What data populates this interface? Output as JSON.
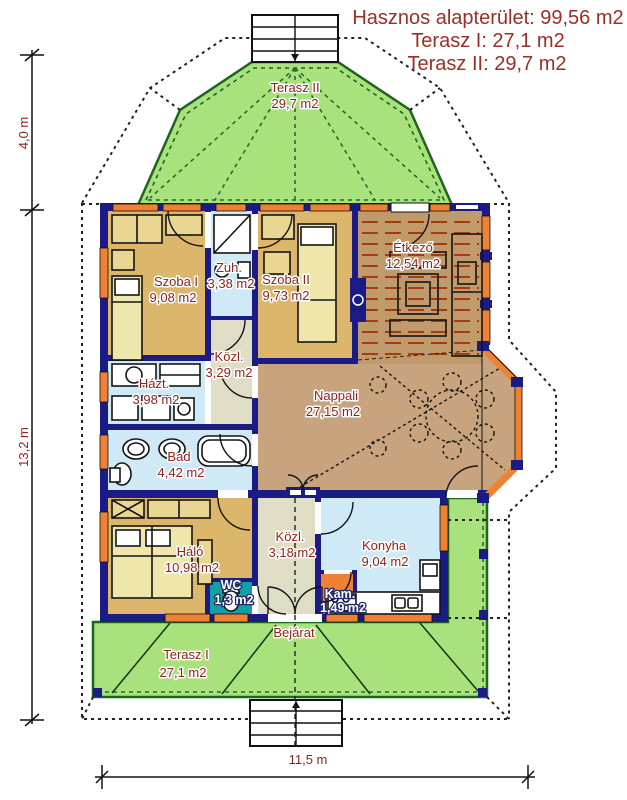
{
  "header": {
    "line1": "Hasznos alapterület: 99,56 m2",
    "line2": "Terasz I: 27,1 m2",
    "line3": "Terasz II: 29,7 m2"
  },
  "rooms": {
    "terasz2": {
      "name": "Terasz II",
      "area": "29,7 m2"
    },
    "szoba1": {
      "name": "Szoba I",
      "area": "9,08 m2"
    },
    "zuh": {
      "name": "Zuh.",
      "area": "3,38 m2"
    },
    "szoba2": {
      "name": "Szoba II",
      "area": "9,73 m2"
    },
    "etkezo": {
      "name": "Étkező",
      "area": "12,54 m2"
    },
    "kozl_felso": {
      "name": "Közl.",
      "area": "3,29 m2"
    },
    "hazt": {
      "name": "Házt.",
      "area": "3,98 m2"
    },
    "bad": {
      "name": "Bad",
      "area": "4,42 m2"
    },
    "nappali": {
      "name": "Nappali",
      "area": "27,15 m2"
    },
    "halo": {
      "name": "Háló",
      "area": "10,98 m2"
    },
    "wc": {
      "name": "WC",
      "area": "1,3 m2"
    },
    "kozl_also": {
      "name": "Közl.",
      "area": "3,18 m2"
    },
    "konyha": {
      "name": "Konyha",
      "area": "9,04 m2"
    },
    "kam": {
      "name": "Kam.",
      "area": "1,49 m2"
    },
    "terasz1": {
      "name": "Terasz I",
      "area": "27,1 m2"
    }
  },
  "labels": {
    "bejarat": "Bejárat"
  },
  "dimensions": {
    "left_upper": "4,0 m",
    "left_lower": "13,2 m",
    "bottom": "11,5 m"
  },
  "colors": {
    "wall_navy": "#1b1b86",
    "terrace_green": "#a9e17d",
    "terrace_edge_green": "#1e651e",
    "bedroom_tan": "#dcb66b",
    "living_tan": "#c7a47d",
    "dining_brown": "#c09a6b",
    "dining_stripe_red": "#a63b10",
    "wet_room_blue": "#cfeaf6",
    "corridor_beige": "#dfddc5",
    "wc_teal": "#12a0a6",
    "window_orange": "#f08033",
    "label_maroon": "#8e241f",
    "header_maroon": "#9b2f26"
  }
}
